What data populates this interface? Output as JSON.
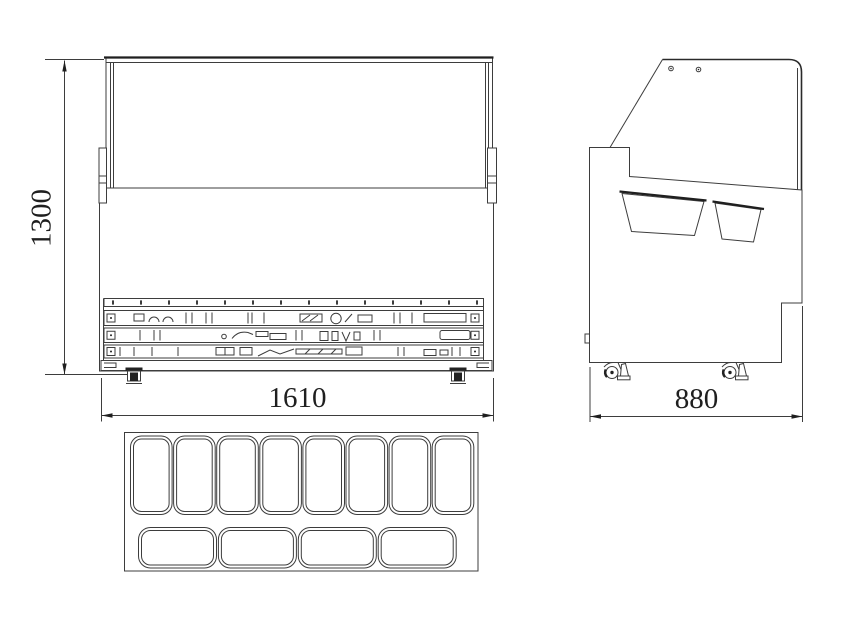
{
  "colors": {
    "line": "#3d3d3d",
    "dark_line": "#1f1f1f",
    "background": "#ffffff",
    "text": "#1f1f1f"
  },
  "dimension_labels": {
    "height": "1300",
    "width": "1610",
    "depth": "880"
  },
  "top_view": {
    "top_row_pan_count": 8,
    "bottom_row_pan_count": 4
  }
}
